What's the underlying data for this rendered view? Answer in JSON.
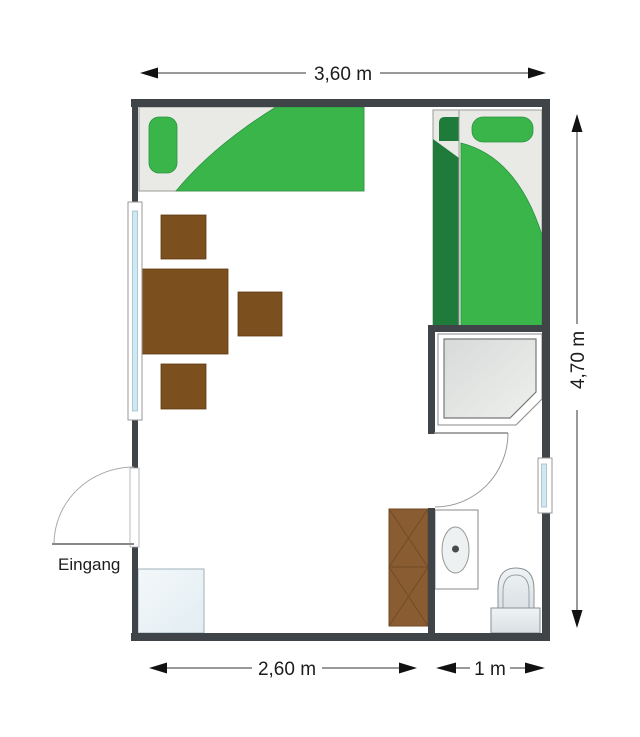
{
  "figure": {
    "type": "floor-plan",
    "language": "de",
    "description_names": [
      "single-bed-left",
      "single-bed-right",
      "dining-table",
      "chairs",
      "shower",
      "sink",
      "toilet",
      "wardrobe",
      "fridge-cabinet",
      "window-left",
      "window-right",
      "entrance-door",
      "bathroom-door"
    ]
  },
  "labels": {
    "entrance": "Eingang"
  },
  "dimensions": {
    "top_width": "3,60 m",
    "right_height": "4,70 m",
    "bottom_room_width": "2,60 m",
    "bottom_bath_width": "1 m"
  },
  "colors": {
    "wall": "#3f4448",
    "bed_green": "#3ab54a",
    "bed_dark_green": "#1e7b3a",
    "bed_frame": "#e9e9e6",
    "wood_brown": "#7b4f1e",
    "cabinet_brown": "#8a5c32",
    "cabinet_line": "#6e4a22",
    "window_glass": "#cde9f4",
    "fixture_light": "#e8edef",
    "dimension_line": "#333333"
  }
}
